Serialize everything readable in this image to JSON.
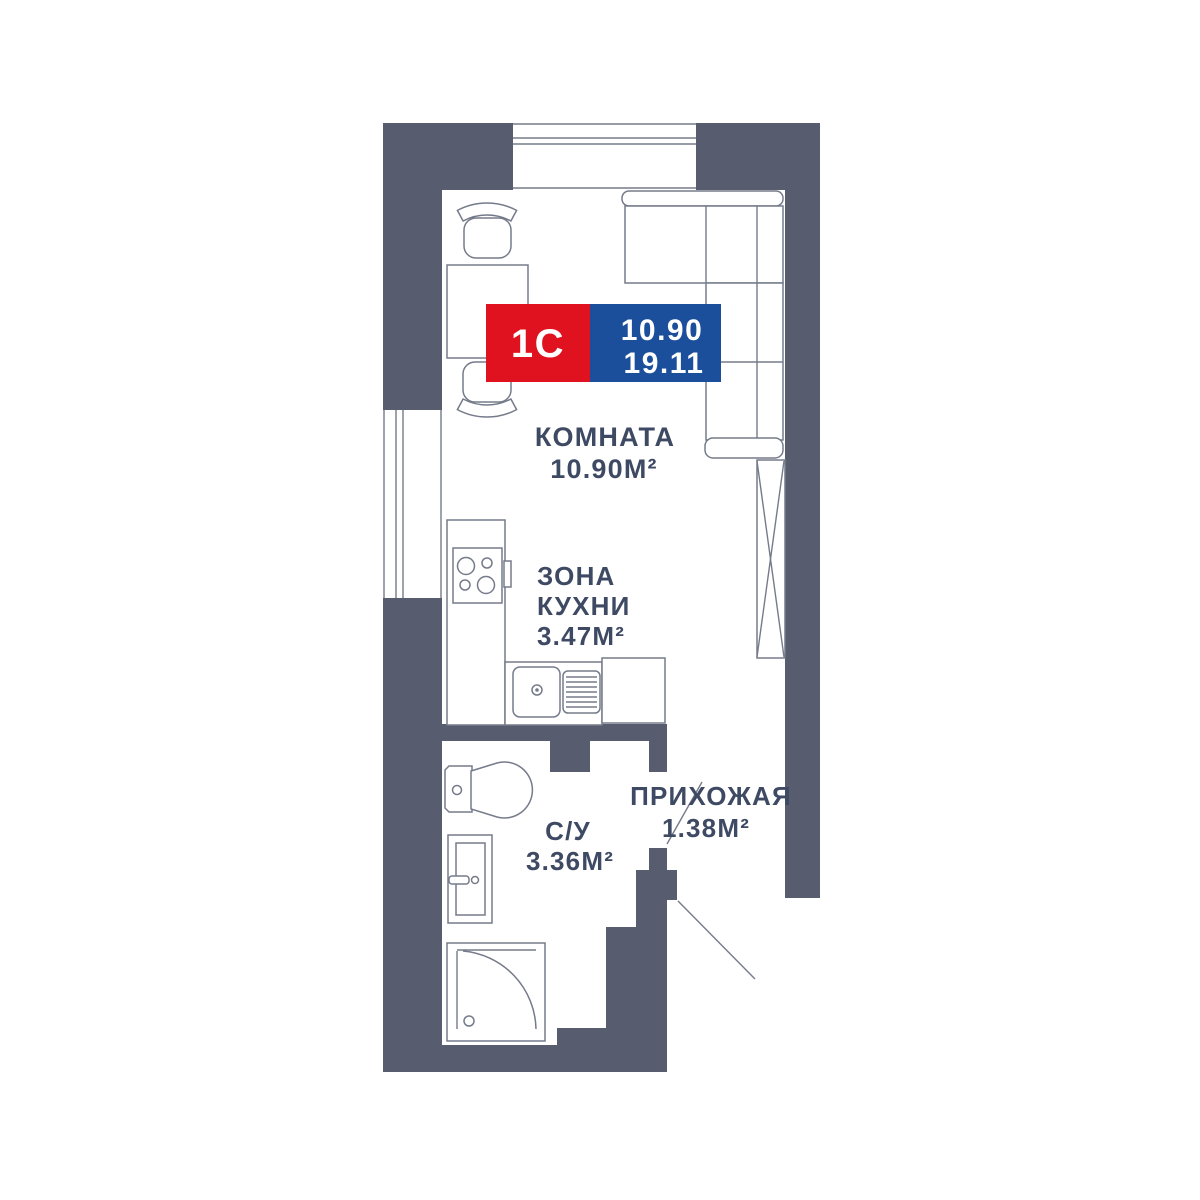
{
  "badge": {
    "type": "1С",
    "value_top": "10.90",
    "value_bottom": "19.11"
  },
  "rooms": {
    "living": {
      "name": "КОМНАТА",
      "area": "10.90М²"
    },
    "kitchen": {
      "line1": "ЗОНА",
      "line2": "КУХНИ",
      "area": "3.47М²"
    },
    "bathroom": {
      "name": "С/У",
      "area": "3.36М²"
    },
    "hallway": {
      "name": "ПРИХОЖАЯ",
      "area": "1.38М²"
    }
  },
  "colors": {
    "wall": "#575D6F",
    "line": "#757B8A",
    "text": "#3E4A63",
    "badge-red": "#E0121F",
    "badge-blue": "#1B4E9B",
    "bg": "#FFFFFF"
  }
}
